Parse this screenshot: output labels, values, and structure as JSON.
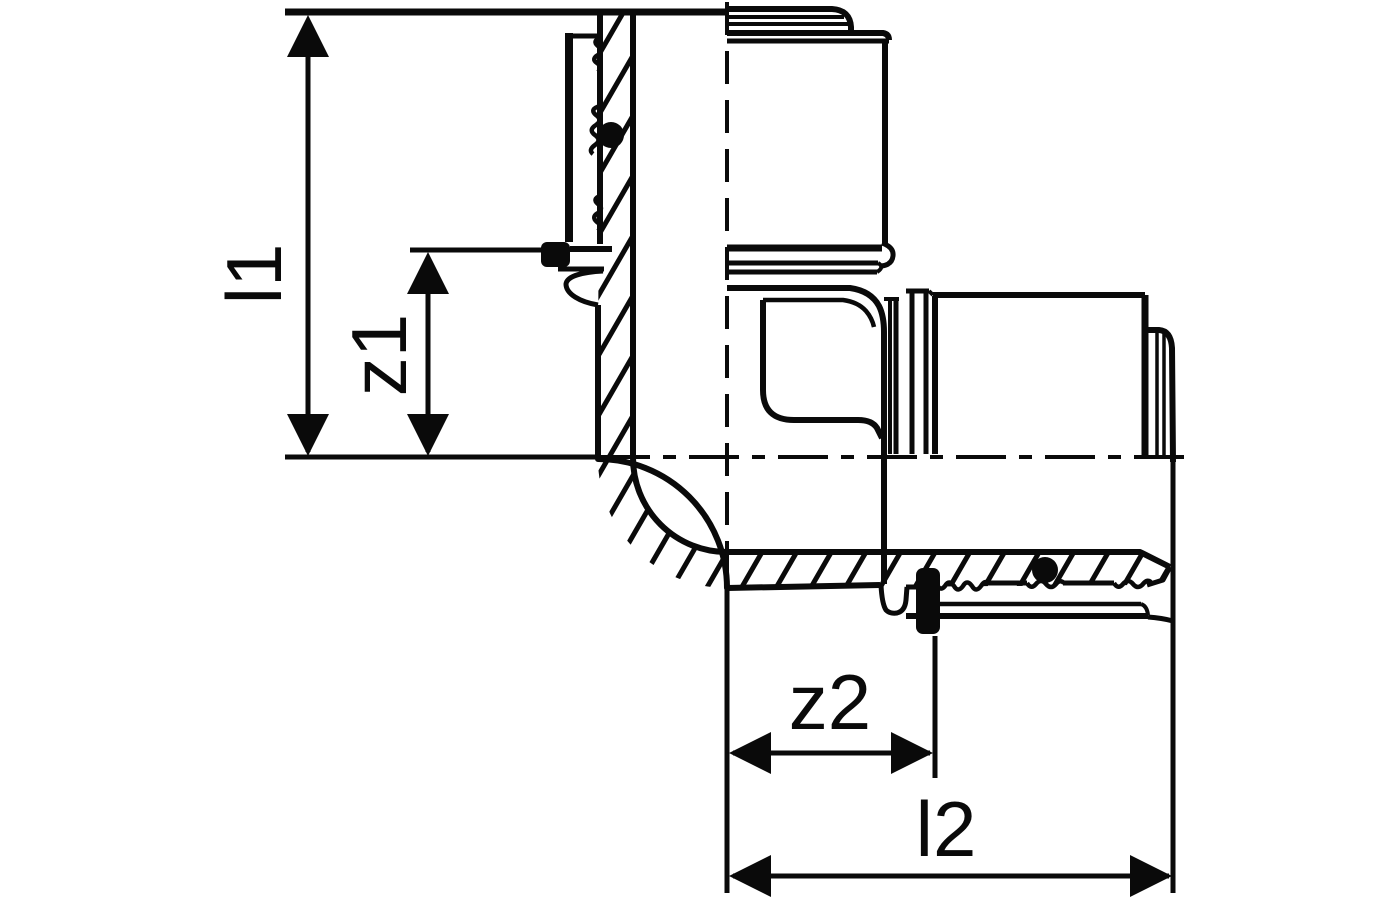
{
  "canvas": {
    "background": "#ffffff",
    "ink": "#0a0a0a"
  },
  "figure": {
    "kind": "technical line drawing",
    "subject": "90-degree press-fit elbow coupling shown in half-section with press sleeves, corrugated sealing beads, O-rings and hatched wall sections"
  },
  "dimensions": {
    "l1": {
      "label": "l1",
      "axis": "vertical",
      "measures": "top end face to horizontal centerline"
    },
    "z1": {
      "label": "z1",
      "axis": "vertical",
      "measures": "vertical-arm insertion stop to horizontal centerline"
    },
    "z2": {
      "label": "z2",
      "axis": "horizontal",
      "measures": "vertical centerline to horizontal-arm insertion stop"
    },
    "l2": {
      "label": "l2",
      "axis": "horizontal",
      "measures": "vertical centerline to right end face"
    }
  }
}
